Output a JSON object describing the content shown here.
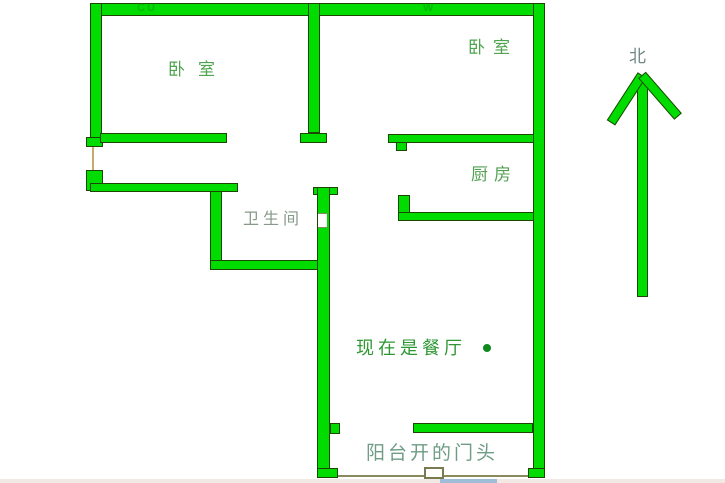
{
  "plan": {
    "rooms": {
      "bedroom1": "卧室",
      "bedroom2": "卧室",
      "kitchen": "厨房",
      "bathroom": "卫生间",
      "dining": "现在是餐厅",
      "balcony": "阳台开的门头"
    },
    "compass": {
      "north_label": "北"
    },
    "watermarks": {
      "wm1": "CU",
      "wm2": "W"
    },
    "colors": {
      "wall_fill": "#00dc00",
      "wall_outline": "#1d4605",
      "bedroom_label": "#4ea34e",
      "kitchen_label": "#55a055",
      "bathroom_label": "#87998a",
      "dining_label": "#2e9733",
      "dining_dot": "#0e8a1e",
      "balcony_label": "#6f9c85",
      "north_label": "#6f8787",
      "door_line": "#c8a96e",
      "background": "#ffffff"
    }
  }
}
